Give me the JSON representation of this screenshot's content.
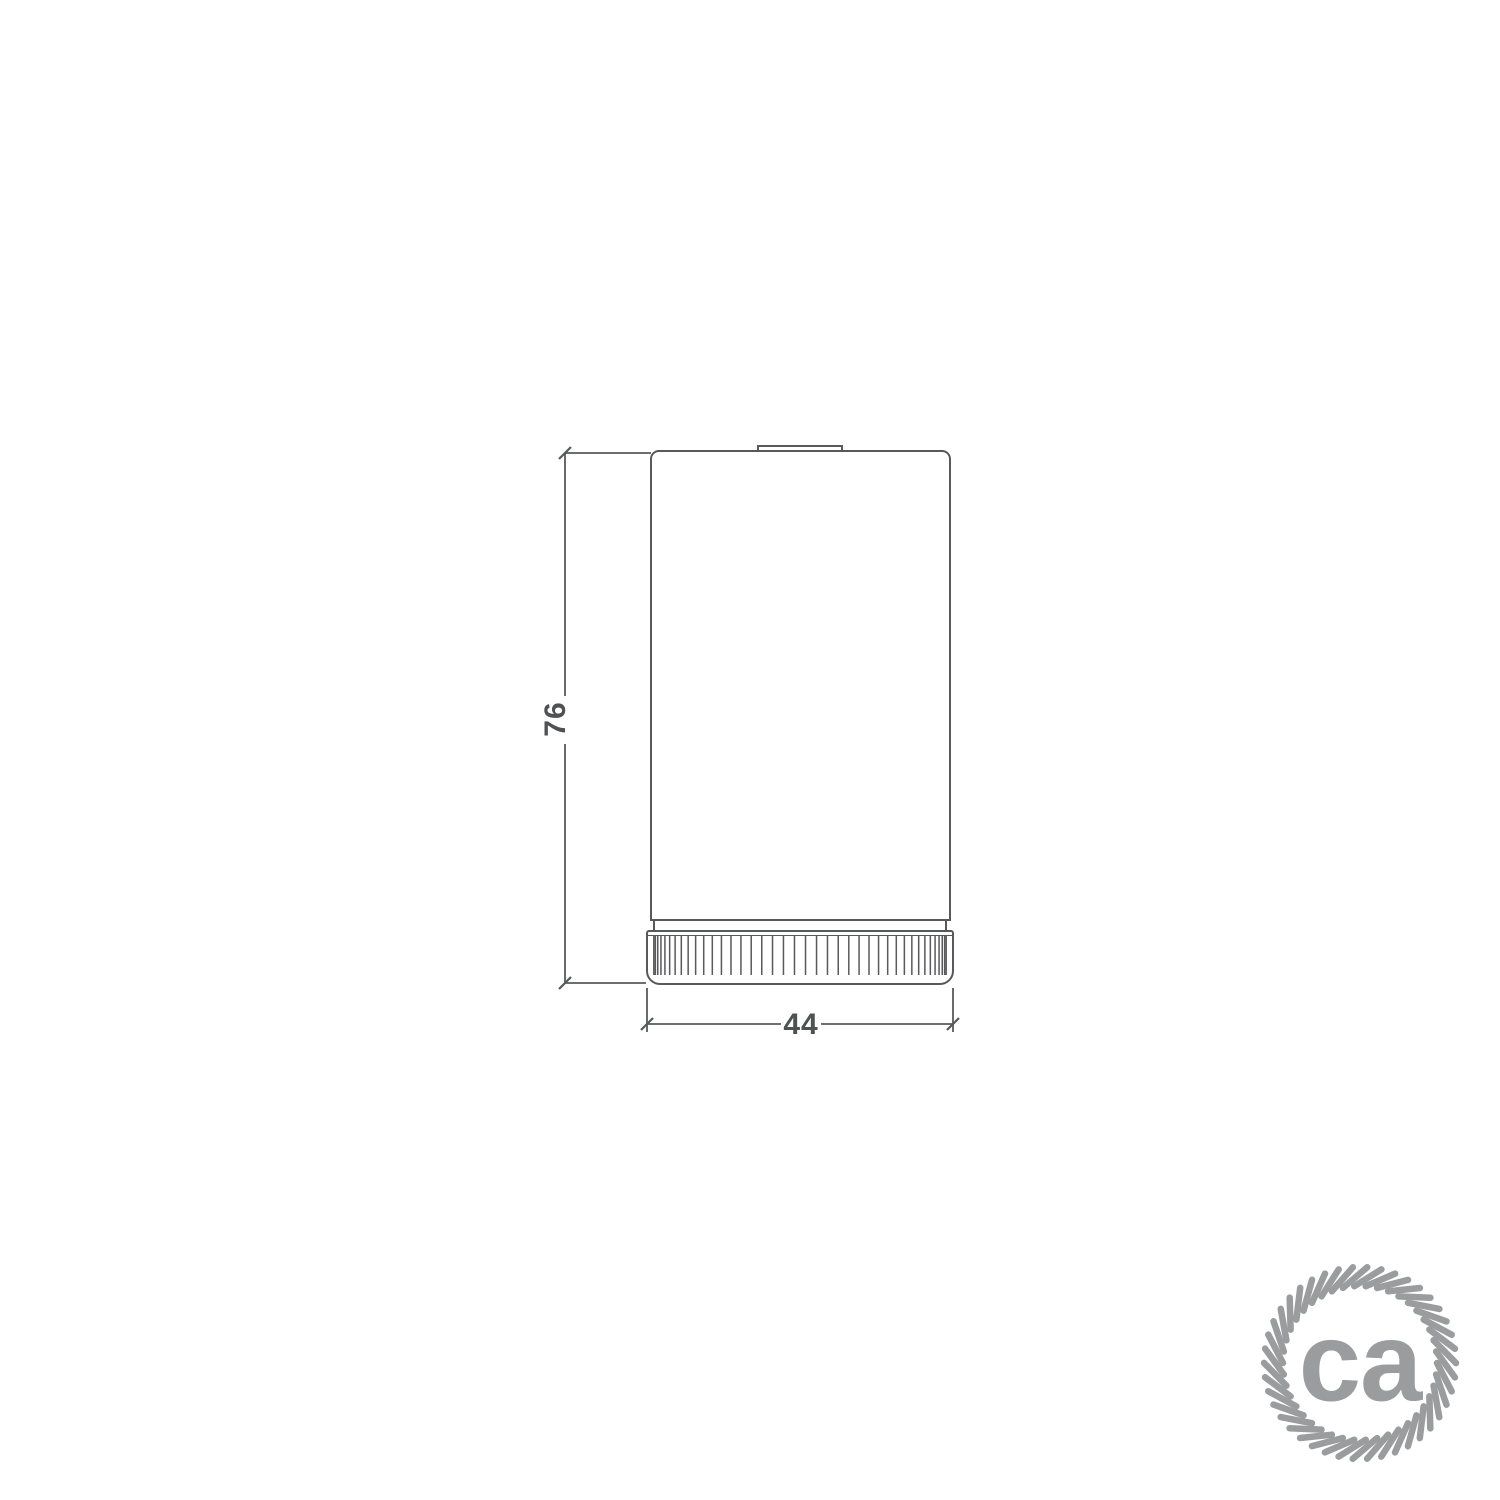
{
  "drawing": {
    "height_label": "76",
    "width_label": "44"
  },
  "logo": {
    "text": "ca",
    "icon": "rope-circle-icon",
    "color": "#9b9c9e"
  },
  "colors": {
    "line": "#58595b",
    "dim_text": "#4f5153",
    "background": "#ffffff"
  }
}
